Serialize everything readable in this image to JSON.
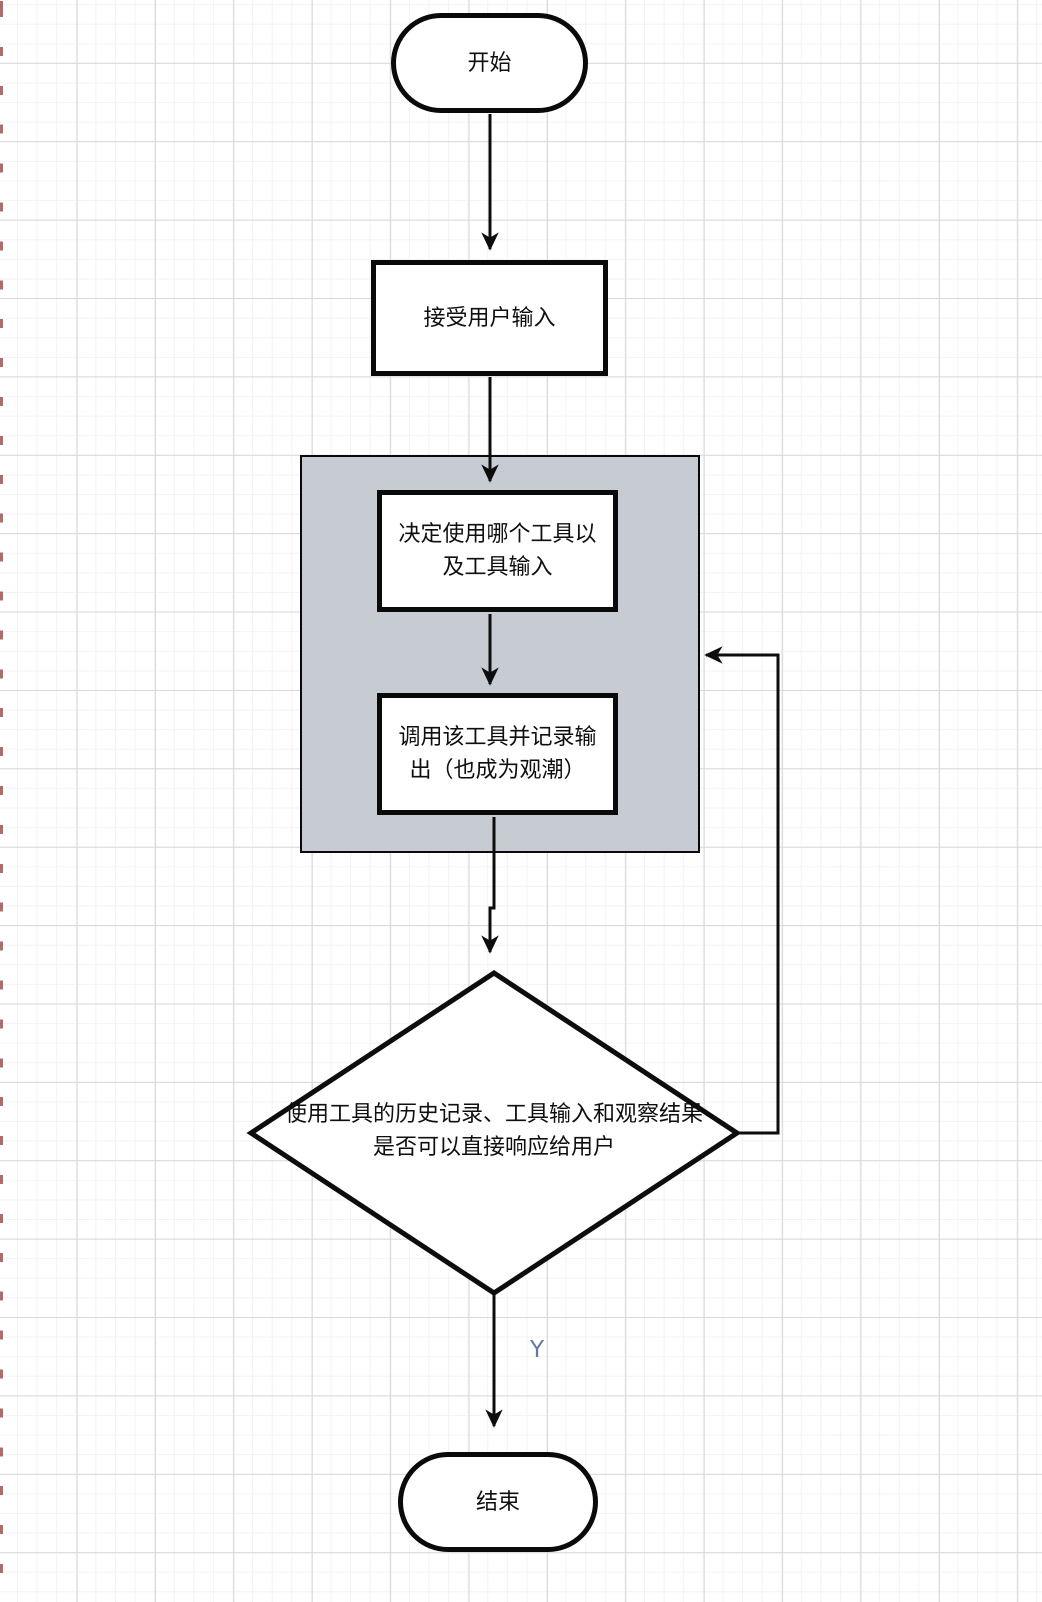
{
  "canvas": {
    "background_color": "#ffffff",
    "grid_minor_color": "#f3f3f3",
    "grid_major_color": "#d8d8d8"
  },
  "colors": {
    "node_border": "#0a0a0a",
    "node_fill": "#ffffff",
    "loop_container_fill": "#c7ccd3",
    "edge_color": "#0d0d0d",
    "yes_label_color": "#64799e"
  },
  "flowchart": {
    "start": {
      "label": "开始",
      "type": "terminal"
    },
    "accept_input": {
      "label": "接受用户输入",
      "type": "process"
    },
    "tool_loop": {
      "decide_tool": {
        "label": "决定使用哪个工具以\n及工具输入",
        "type": "process"
      },
      "call_tool": {
        "label": "调用该工具并记录输\n出（也成为观潮）",
        "type": "process"
      }
    },
    "decision": {
      "label": "使用工具的历史记录、工具输入和观察结果\n是否可以直接响应给用户",
      "type": "decision",
      "yes_branch_label": "Y"
    },
    "end": {
      "label": "结束",
      "type": "terminal"
    }
  }
}
